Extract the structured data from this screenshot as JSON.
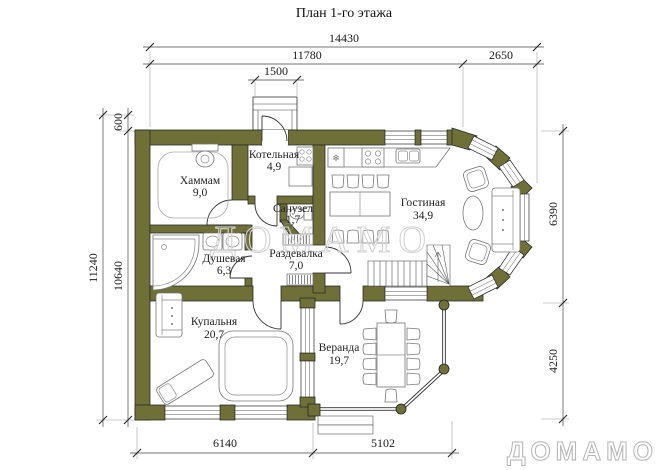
{
  "title": "План 1-го этажа",
  "watermark": "ДОМАМО",
  "brand_logo": "ДОМАМО",
  "colors": {
    "wall": "#6e7038",
    "line": "#2b2b2b",
    "watermark": "#d2d2d2",
    "logo": "#b3b3b3"
  },
  "rooms": [
    {
      "id": "hammam",
      "name": "Хаммам",
      "area": "9,0"
    },
    {
      "id": "kotelnaya",
      "name": "Котельная",
      "area": "4,9"
    },
    {
      "id": "sanuzel",
      "name": "Санузел",
      "area": "1,7"
    },
    {
      "id": "razdevalka",
      "name": "Раздевалка",
      "area": "7,0"
    },
    {
      "id": "dushevaya",
      "name": "Душевая",
      "area": "6,3"
    },
    {
      "id": "gostinaya",
      "name": "Гостиная",
      "area": "34,9"
    },
    {
      "id": "kupalnya",
      "name": "Купальня",
      "area": "20,7"
    },
    {
      "id": "veranda",
      "name": "Веранда",
      "area": "19,7"
    }
  ],
  "dimensions": {
    "top_total": "14430",
    "top_main": "11780",
    "top_right": "2650",
    "porch": "1500",
    "left_total": "11240",
    "left_wall": "600",
    "left_inner": "10640",
    "right_upper": "6390",
    "right_lower": "4250",
    "bottom_left": "6140",
    "bottom_right": "5102"
  }
}
